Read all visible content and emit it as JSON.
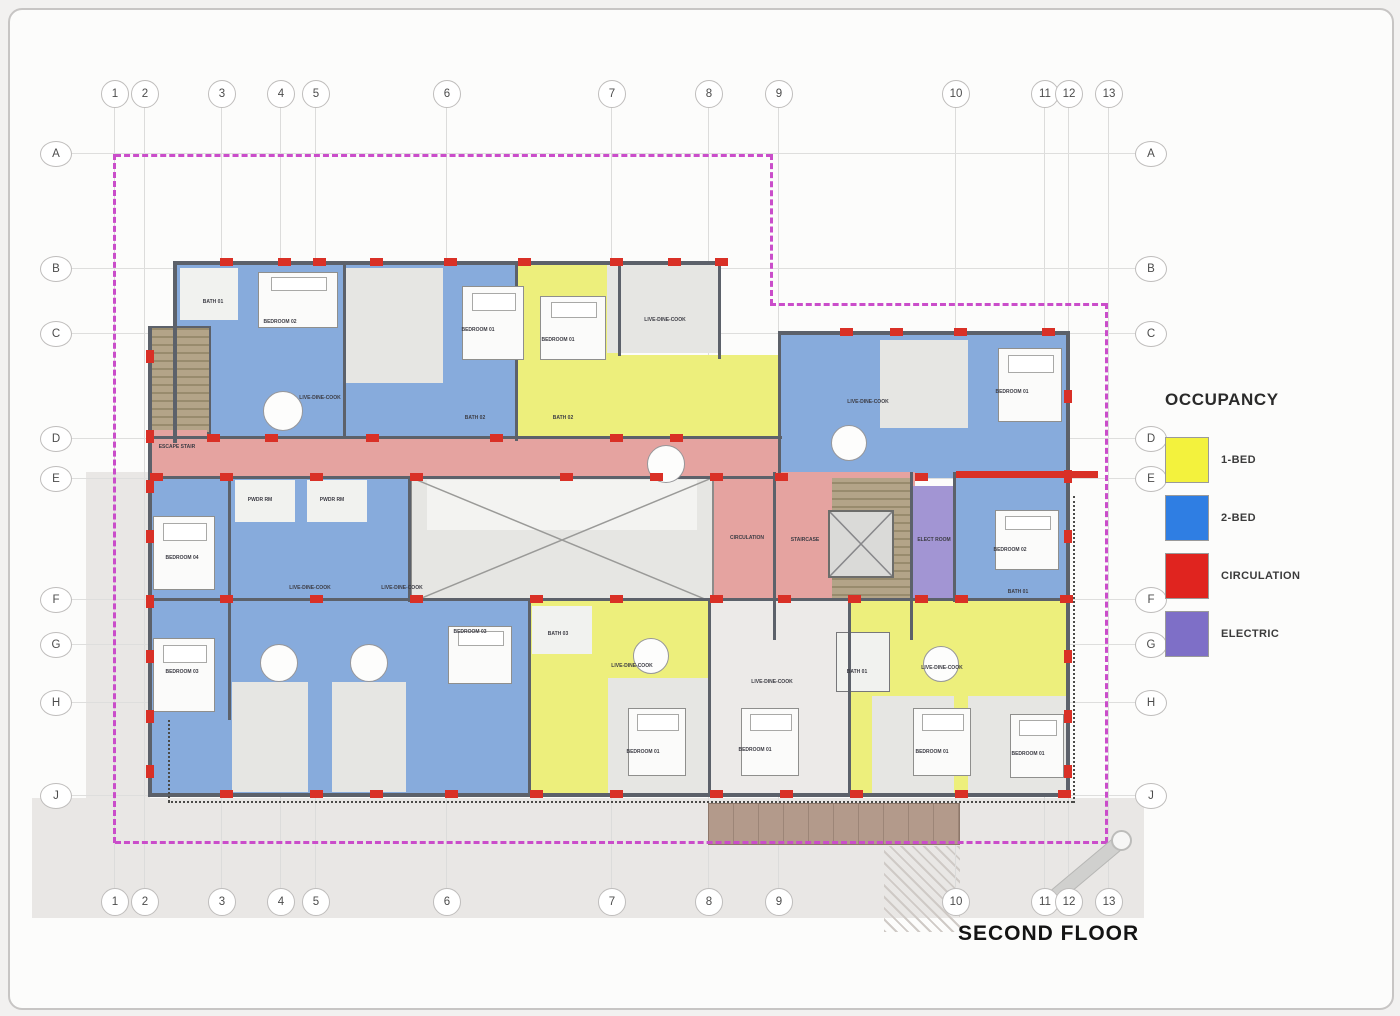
{
  "page": {
    "title": "SECOND FLOOR"
  },
  "grid": {
    "columns": [
      {
        "label": "1",
        "x": 104
      },
      {
        "label": "2",
        "x": 134
      },
      {
        "label": "3",
        "x": 211
      },
      {
        "label": "4",
        "x": 270
      },
      {
        "label": "5",
        "x": 305
      },
      {
        "label": "6",
        "x": 436
      },
      {
        "label": "7",
        "x": 601
      },
      {
        "label": "8",
        "x": 698
      },
      {
        "label": "9",
        "x": 768
      },
      {
        "label": "10",
        "x": 945
      },
      {
        "label": "11",
        "x": 1034
      },
      {
        "label": "12",
        "x": 1058
      },
      {
        "label": "13",
        "x": 1098
      }
    ],
    "rows": [
      {
        "label": "A",
        "y": 143
      },
      {
        "label": "B",
        "y": 258
      },
      {
        "label": "C",
        "y": 323
      },
      {
        "label": "D",
        "y": 428
      },
      {
        "label": "E",
        "y": 468
      },
      {
        "label": "F",
        "y": 589
      },
      {
        "label": "G",
        "y": 634
      },
      {
        "label": "H",
        "y": 692
      },
      {
        "label": "J",
        "y": 785
      }
    ]
  },
  "legend": {
    "title": "OCCUPANCY",
    "items": [
      {
        "label": "1-BED",
        "color": "#f3f23d"
      },
      {
        "label": "2-BED",
        "color": "#2f7ee3"
      },
      {
        "label": "CIRCULATION",
        "color": "#e0241f"
      },
      {
        "label": "ELECTRIC",
        "color": "#7e6fc7"
      }
    ]
  },
  "plan": {
    "boundary_color": "#ca4dca",
    "rooms": [
      {
        "text": "ESCAPE STAIR",
        "x": 167,
        "y": 437
      },
      {
        "text": "BATH 01",
        "x": 203,
        "y": 292
      },
      {
        "text": "BEDROOM 02",
        "x": 270,
        "y": 312
      },
      {
        "text": "LIVE-DINE-COOK",
        "x": 310,
        "y": 388
      },
      {
        "text": "PWDR RM",
        "x": 250,
        "y": 490
      },
      {
        "text": "PWDR RM",
        "x": 322,
        "y": 490
      },
      {
        "text": "BEDROOM 01",
        "x": 468,
        "y": 320
      },
      {
        "text": "BATH 02",
        "x": 465,
        "y": 408
      },
      {
        "text": "BATH 02",
        "x": 553,
        "y": 408
      },
      {
        "text": "BEDROOM 01",
        "x": 548,
        "y": 330
      },
      {
        "text": "LIVE-DINE-COOK",
        "x": 655,
        "y": 310
      },
      {
        "text": "LIVE-DINE-COOK",
        "x": 858,
        "y": 392
      },
      {
        "text": "BEDROOM 01",
        "x": 1002,
        "y": 382
      },
      {
        "text": "CIRCULATION",
        "x": 737,
        "y": 528
      },
      {
        "text": "STAIRCASE",
        "x": 795,
        "y": 530
      },
      {
        "text": "ELECT ROOM",
        "x": 924,
        "y": 530
      },
      {
        "text": "BEDROOM 02",
        "x": 1000,
        "y": 540
      },
      {
        "text": "BATH 01",
        "x": 1008,
        "y": 582
      },
      {
        "text": "BEDROOM 04",
        "x": 172,
        "y": 548
      },
      {
        "text": "BEDROOM 03",
        "x": 172,
        "y": 662
      },
      {
        "text": "LIVE-DINE-COOK",
        "x": 300,
        "y": 578
      },
      {
        "text": "LIVE-DINE-COOK",
        "x": 392,
        "y": 578
      },
      {
        "text": "BEDROOM 03",
        "x": 460,
        "y": 622
      },
      {
        "text": "BATH 03",
        "x": 548,
        "y": 624
      },
      {
        "text": "LIVE-DINE-COOK",
        "x": 622,
        "y": 656
      },
      {
        "text": "BEDROOM 01",
        "x": 633,
        "y": 742
      },
      {
        "text": "LIVE-DINE-COOK",
        "x": 762,
        "y": 672
      },
      {
        "text": "BEDROOM 01",
        "x": 745,
        "y": 740
      },
      {
        "text": "LIVE-DINE-COOK",
        "x": 932,
        "y": 658
      },
      {
        "text": "BATH 01",
        "x": 847,
        "y": 662
      },
      {
        "text": "BEDROOM 01",
        "x": 922,
        "y": 742
      },
      {
        "text": "BEDROOM 01",
        "x": 1018,
        "y": 744
      }
    ]
  }
}
